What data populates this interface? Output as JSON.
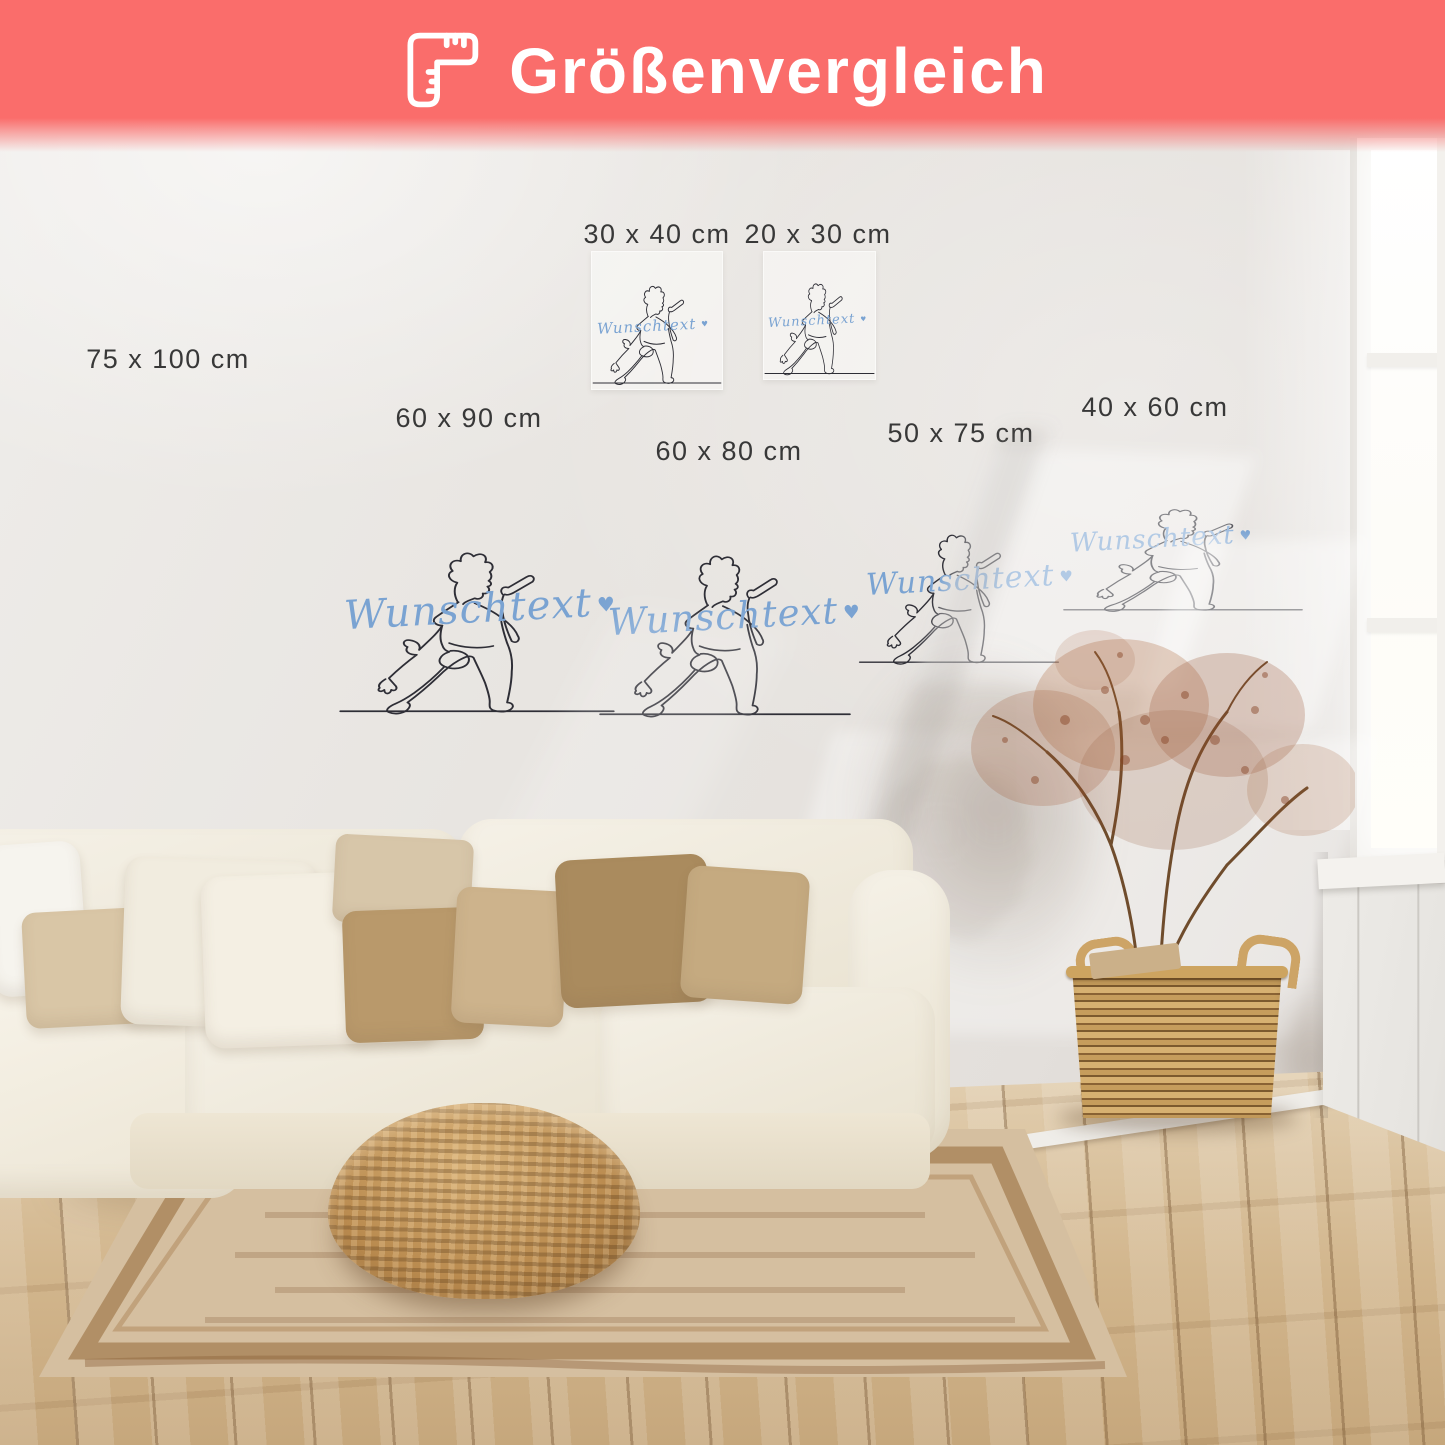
{
  "banner": {
    "title": "Größenvergleich",
    "icon": "corner-ruler-icon",
    "bg_color": "#fa6d6b",
    "text_color": "#ffffff"
  },
  "wall_art": {
    "custom_text": "Wunschtext",
    "heart": "♥",
    "text_color": "#7aa3d2",
    "line_color": "#2e2e36",
    "subject": "one-line drawing of a singer holding a microphone"
  },
  "size_labels": [
    {
      "text": "75 x 100 cm"
    },
    {
      "text": "30 x 40 cm"
    },
    {
      "text": "20 x 30 cm"
    },
    {
      "text": "60 x 90 cm"
    },
    {
      "text": "60 x 80 cm"
    },
    {
      "text": "50 x 75 cm"
    },
    {
      "text": "40 x 60 cm"
    }
  ],
  "palette": {
    "wall": "#e8e5e1",
    "floor_wood": "#d2b68d",
    "rug": "#d5bfa0",
    "rug_border": "#9e7446",
    "sofa": "#f1ecdf",
    "pillow_beige": "#d9c6a6",
    "pillow_brown": "#ab8c5f",
    "pouf_wicker": "#b98a4e",
    "basket_wicker": "#c69d5c",
    "dried_plant": "#a0582d",
    "label_text": "#383838"
  }
}
